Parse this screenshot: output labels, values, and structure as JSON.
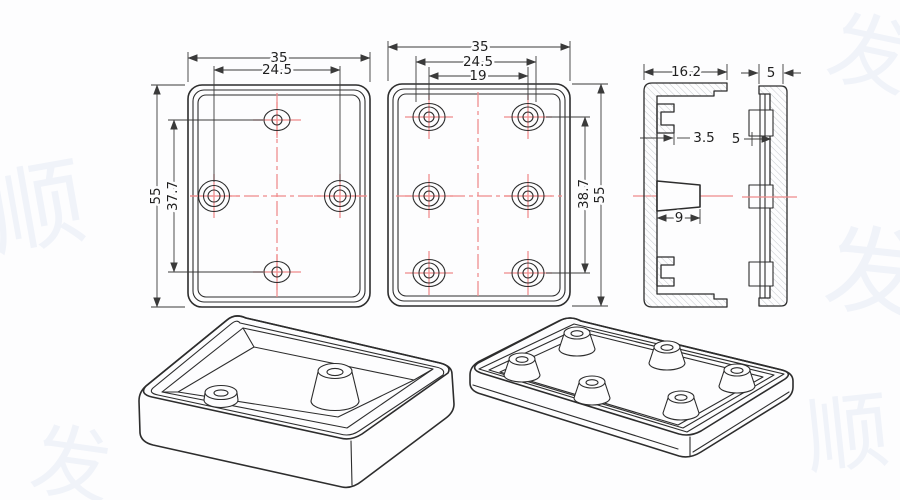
{
  "colors": {
    "background": "#fdfdfe",
    "line": "#2d2d2d",
    "dim_line": "#3a3a3a",
    "centerline": "#f08a8a",
    "hatch": "#c4c7cc",
    "text": "#1f1f1f",
    "watermark": "#f0f3f9"
  },
  "dims": {
    "v1_width": "35",
    "v1_span": "24.5",
    "v1_height": "55",
    "v1_vspan": "37.7",
    "v2_width": "35",
    "v2_span": "24.5",
    "v2_holes": "19",
    "v2_vspan": "38.7",
    "v2_height": "55",
    "v3_depth": "16.2",
    "v3_rib": "3.5",
    "v3_boss": "9",
    "v4_width": "5",
    "v4_lip": "5"
  },
  "watermark_glyphs": [
    "顺",
    "发"
  ]
}
